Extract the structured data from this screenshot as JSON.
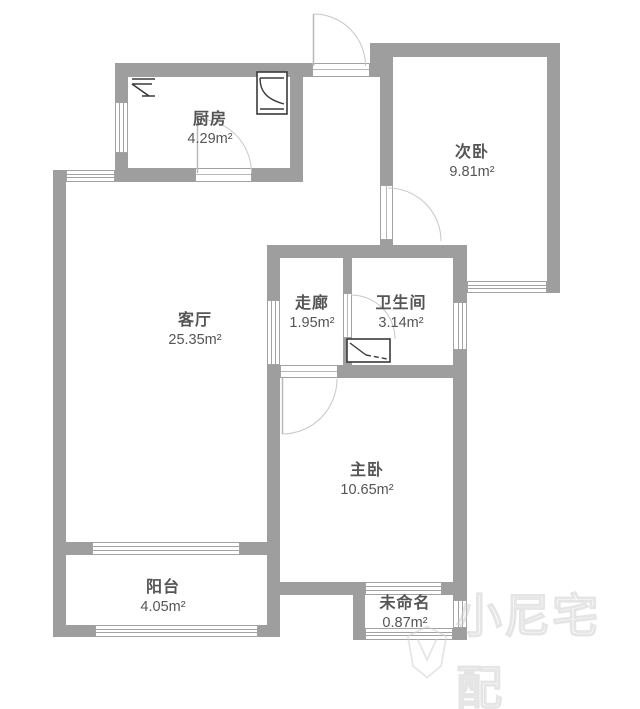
{
  "meta": {
    "type": "apartment-floor-plan",
    "canvas": {
      "width": 640,
      "height": 709
    },
    "colors": {
      "background": "#ffffff",
      "wall": "#9e9e9e",
      "window_line": "#a2a2a2",
      "door_arc": "#c7c7c7",
      "label_text": "#555555",
      "fixture_stroke": "#3a3a3a",
      "watermark": "#d0d0d0"
    }
  },
  "rooms": [
    {
      "id": "kitchen",
      "name": "厨房",
      "area": "4.29m²"
    },
    {
      "id": "second-bedroom",
      "name": "次卧",
      "area": "9.81m²"
    },
    {
      "id": "living-room",
      "name": "客厅",
      "area": "25.35m²"
    },
    {
      "id": "corridor",
      "name": "走廊",
      "area": "1.95m²"
    },
    {
      "id": "bathroom",
      "name": "卫生间",
      "area": "3.14m²"
    },
    {
      "id": "master-bedroom",
      "name": "主卧",
      "area": "10.65m²"
    },
    {
      "id": "balcony",
      "name": "阳台",
      "area": "4.05m²"
    },
    {
      "id": "unnamed",
      "name": "未命名",
      "area": "0.87m²"
    }
  ],
  "watermark": {
    "text": "小尼宅配"
  }
}
